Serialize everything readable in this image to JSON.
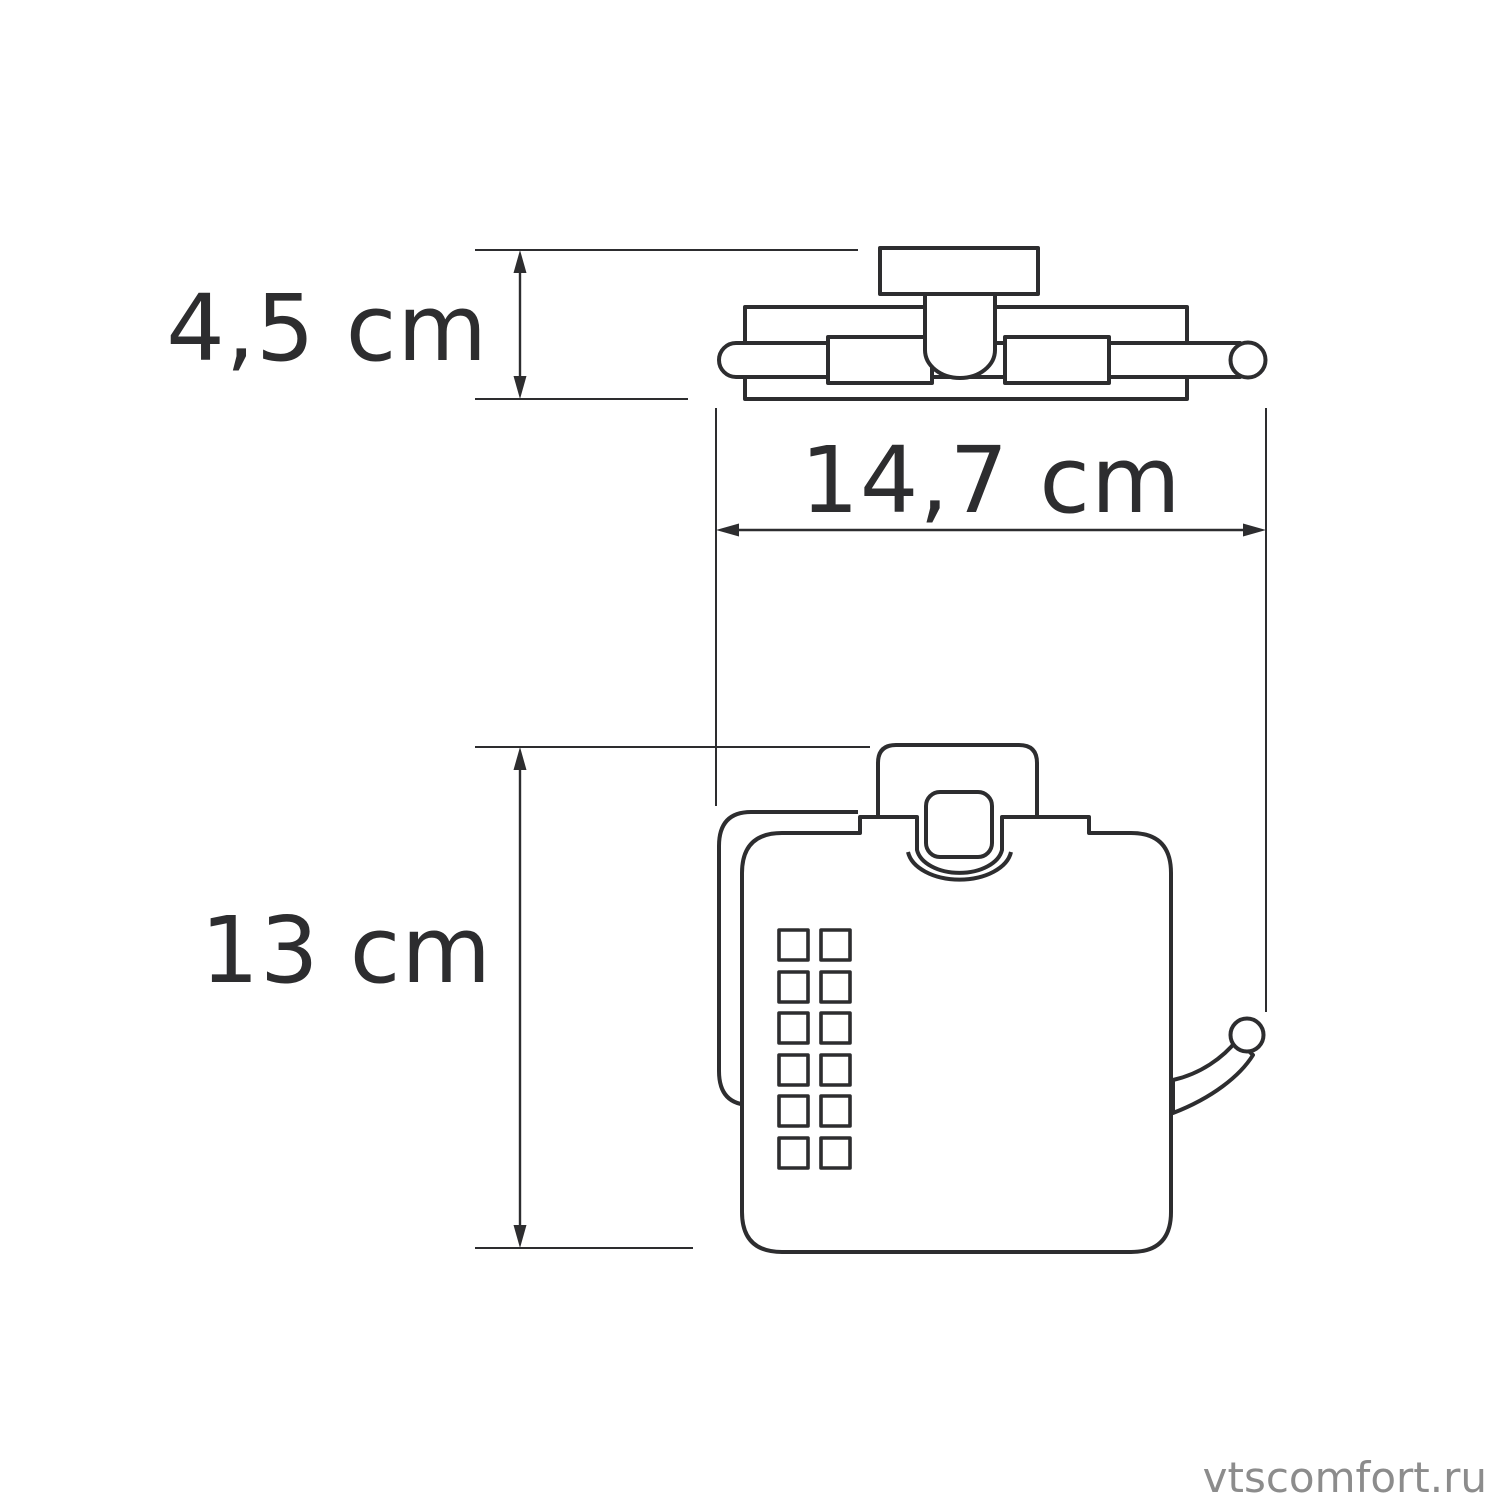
{
  "palette": {
    "background": "#ffffff",
    "line": "#2d2d2f",
    "watermark": "#8c8c8c"
  },
  "drawing": {
    "type": "product dimension diagram",
    "views": {
      "top_view": "toilet paper holder seen from above: wall plate, roll bar with end cap, mounting knob",
      "front_view": "toilet paper holder with cover: back plate, lid with latch, ventilation grid of 12 square perforations, roll spindle with ball end"
    }
  },
  "dimension_labels": {
    "depth": "4,5 cm",
    "width": "14,7 cm",
    "height": "13 cm"
  },
  "watermark": {
    "text": "vtscomfort.ru"
  }
}
